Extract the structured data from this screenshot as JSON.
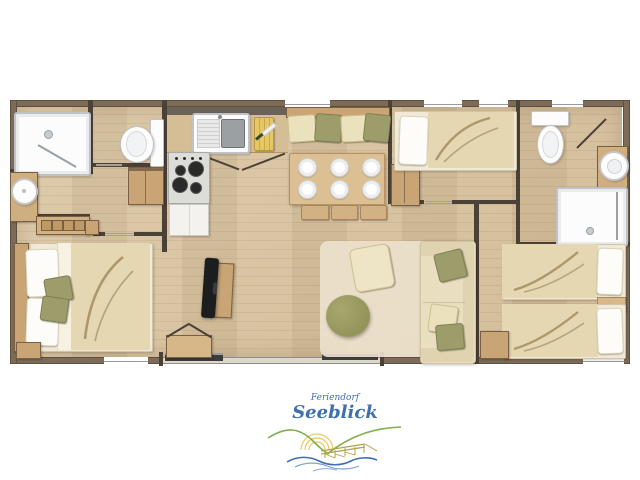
{
  "logo": {
    "brand_top": "Feriendorf",
    "brand_name": "Seeblick"
  },
  "theme": {
    "pageBg": "#ffffff",
    "outerWall": "#7d6a57",
    "innerWall": "#4c4137",
    "wood": "#c9a475",
    "woodMid": "#d2b183",
    "woodLight": "#d5bd96",
    "woodEdge": "#7a5f42",
    "fixtureWhite": "#fcfcfc",
    "fixtureBorder": "#bfc3c7",
    "steel": "#9ba1a3",
    "bedding": "#f1e9d5",
    "blanket": "#e6d7b3",
    "blanketFold": "#a28d5f",
    "pillowWhite": "#fdfcf8",
    "cushionOlive": "#9d9d6b",
    "cushionCream": "#ece1bd",
    "sofa": "#e9debf",
    "rug": "#ebe1cc",
    "poufOlive": "#8c8c52",
    "tvBlack": "#1c1d1f",
    "stoveGray": "#dcdcd8",
    "burner": "#2a2a2a",
    "counterDark": "#6a6157",
    "boardYellow": "#e6c766",
    "knifeGreen": "#2f4a2e",
    "logoBlue": "#3e6fae",
    "waveBlue": "#3f6fb0",
    "hillGreen": "#7fae4e",
    "sunYellow": "#e9c34c",
    "pierOlive": "#b0a24c"
  },
  "floorplan": {
    "items": [
      "shower-tray",
      "washbasin",
      "towel-bench",
      "toilet",
      "kitchen-counter",
      "kitchen-sink",
      "cutting-board",
      "stove",
      "kitchen-cabinet",
      "hall-cabinet",
      "dining-bench",
      "seat-cushions",
      "dining-table",
      "plates",
      "stools",
      "wardrobe",
      "single-bed",
      "double-bed",
      "pillows",
      "second-toilet",
      "second-washbasin",
      "second-shower-tray",
      "tv",
      "tv-stand",
      "storage-box",
      "rug",
      "floor-cushion",
      "pouf",
      "sofa",
      "twin-beds",
      "nightstand",
      "sliding-patio-door",
      "windows"
    ]
  }
}
